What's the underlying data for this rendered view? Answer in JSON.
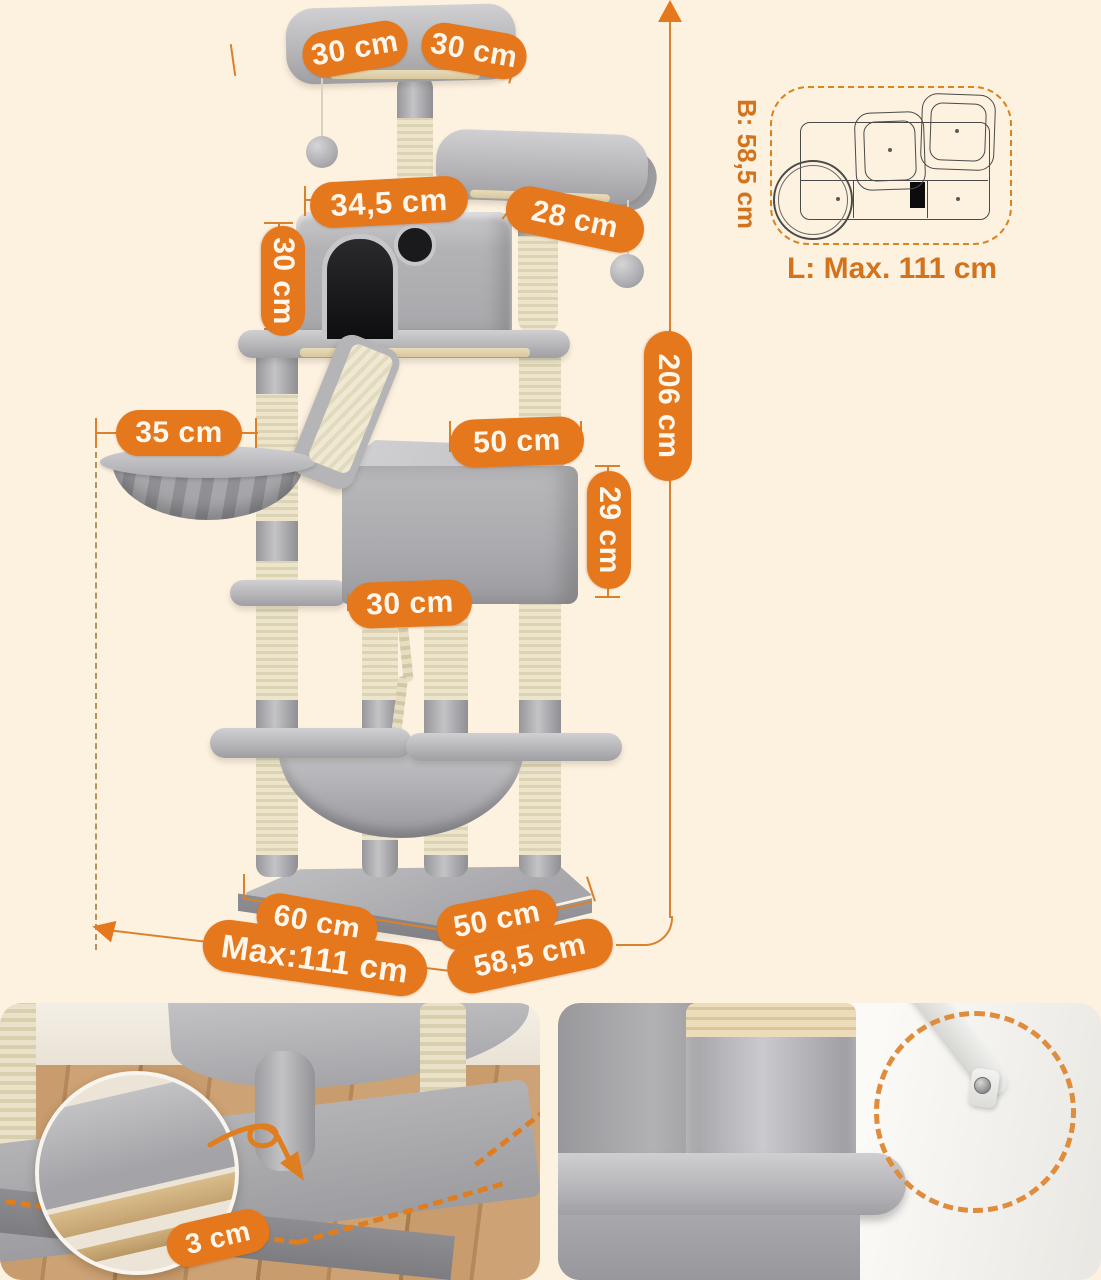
{
  "dims": {
    "top_left": "30 cm",
    "top_right": "30 cm",
    "house_width": "34,5 cm",
    "perch_depth": "28 cm",
    "house_height": "30 cm",
    "basket_width": "35 cm",
    "condo_width": "50 cm",
    "condo_height": "29 cm",
    "shelf_width": "30 cm",
    "total_height": "206 cm",
    "base_front_width": "60 cm",
    "base_side_depth": "50 cm",
    "base_max_length": "Max:111 cm",
    "base_diagonal_depth": "58,5 cm",
    "board_thickness": "3 cm"
  },
  "footprint": {
    "width": "B: 58,5 cm",
    "length": "L: Max. 111 cm"
  },
  "colors": {
    "accent": "#e5771d",
    "background": "#fdf1e0",
    "plush_gray": "#b6b6b9",
    "sisal": "#e5ddc0"
  }
}
